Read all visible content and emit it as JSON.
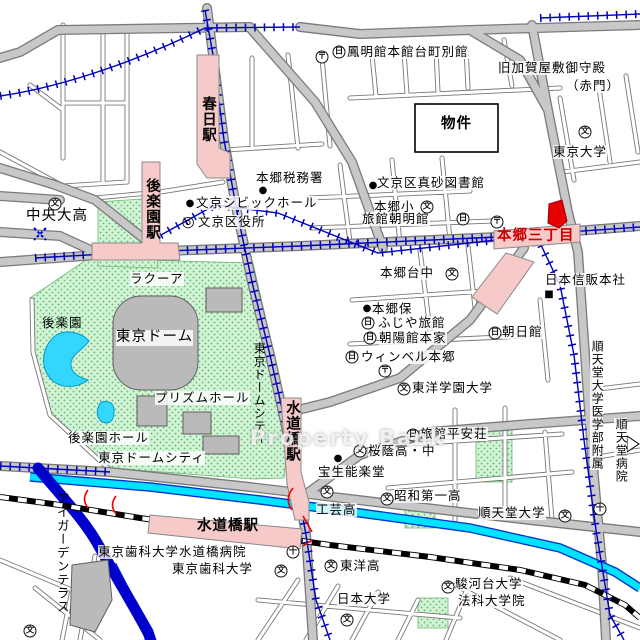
{
  "watermark": "Property Bank",
  "glyphs": {
    "school": "文",
    "hospital": "十",
    "post": "〒",
    "ward": "◎",
    "hotel": "日",
    "dot": "●",
    "square": "■",
    "arrow": "▷",
    "cross": "✕"
  },
  "colors": {
    "road_major": "#c8c8c8",
    "road_casing": "#7a7a7a",
    "park_green": "#d4f3d4",
    "park_dot": "#55bb77",
    "pond_cyan": "#33d6ff",
    "river_cyan": "#00e2ff",
    "river_casing": "#0033cc",
    "canal_blue": "#0000cc",
    "subway_blue": "#0000bb",
    "station_pink": "#f7caca",
    "property_red": "#e60000",
    "station_text_red": "#cc0000"
  },
  "labels": {
    "chuo_dai_high": "中央大高",
    "kasuga_station": "春日駅",
    "korakuen_station": "後楽園駅",
    "bunkyo_civic_hall": "文京シビックホール",
    "bunkyo_ward_office": "文京区役所",
    "laqua": "ラクーア",
    "hongo_tax_office": "本郷税務署",
    "homeikan": "鳳明館本館台町別館",
    "kaga_yashiki": "旧加賀屋敷御守殿",
    "akamon": "（赤門）",
    "bukken": "物件",
    "tokyo_university": "東京大学",
    "masago_library": "文京区真砂図書館",
    "hongo_elementary": "本郷小",
    "ryokan_chomeikan": "旅館朝明館",
    "hongo_sanchome": "本郷三丁目",
    "nihon_shinpan": "日本信販本社",
    "hongodai_jhs": "本郷台中",
    "hongo_nursery": "本郷保",
    "fujiya_ryokan": "ふじや旅館",
    "choyokan_honke": "朝陽館本家",
    "winbell_hongo": "ウィンベル本郷",
    "asahikan": "朝日館",
    "toyo_gakuen_univ": "東洋学園大学",
    "juntendo_med": "順天堂大学医学部附属",
    "juntendo_hospital": "順天堂病院",
    "ryokan_heianso": "旅館平安荘",
    "oin_school": "桜蔭高・中",
    "hosho_noh": "宝生能楽堂",
    "showa_daiichi": "昭和第一高",
    "juntendo_univ": "順天堂大学",
    "kogei_high": "工芸高",
    "suidobashi_east": "水道橋駅",
    "dome_city_v": "東京ドームシティ",
    "korakuen_garden": "後楽園",
    "tokyo_dome": "東京ドーム",
    "prism_hall": "プリズムホール",
    "korakuen_hall": "後楽園ホール",
    "dome_city": "東京ドームシティ",
    "i_garden": "アイガーデンテラス",
    "suidobashi_jr": "水道橋駅",
    "dental_hospital": "東京歯科大学水道橋病院",
    "dental_univ": "東京歯科大学",
    "toyo_high": "東洋高",
    "nihon_univ": "日本大学",
    "surugadai_univ": "駿河台大学",
    "law_school": "法科大学院"
  }
}
